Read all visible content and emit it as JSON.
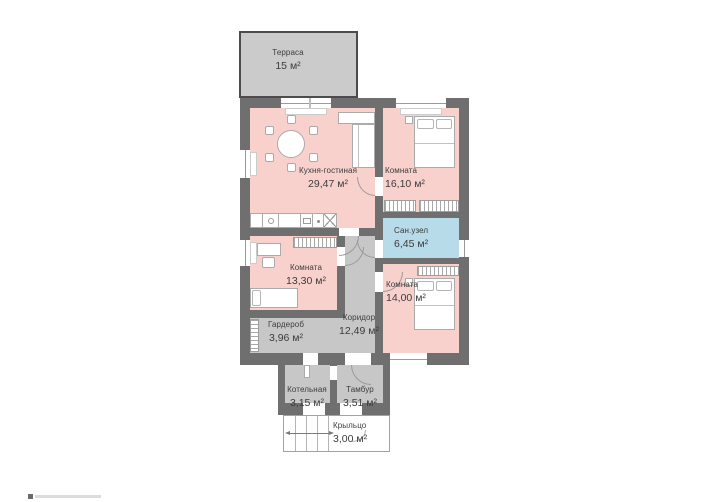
{
  "colors": {
    "wall": "#6f6f6f",
    "room-pink": "#f8d1cd",
    "room-blue": "#b7dbe9",
    "room-gray": "#c7c7c7",
    "terrace-gray": "#cbcbcb",
    "text": "#3c3c3c"
  },
  "rooms": [
    {
      "name": "Терраса",
      "area": "15 м²"
    },
    {
      "name": "Кухня-гостиная",
      "area": "29,47 м²"
    },
    {
      "name": "Комната",
      "area": "16,10 м²"
    },
    {
      "name": "Сан.узел",
      "area": "6,45 м²"
    },
    {
      "name": "Комната",
      "area": "14,00 м²"
    },
    {
      "name": "Комната",
      "area": "13,30 м²"
    },
    {
      "name": "Гардероб",
      "area": "3,96 м²"
    },
    {
      "name": "Коридор",
      "area": "12,49 м²"
    },
    {
      "name": "Котельная",
      "area": "3,15 м²"
    },
    {
      "name": "Тамбур",
      "area": "3,51 м²"
    },
    {
      "name": "Крыльцо",
      "area": "3,00 м²"
    }
  ]
}
